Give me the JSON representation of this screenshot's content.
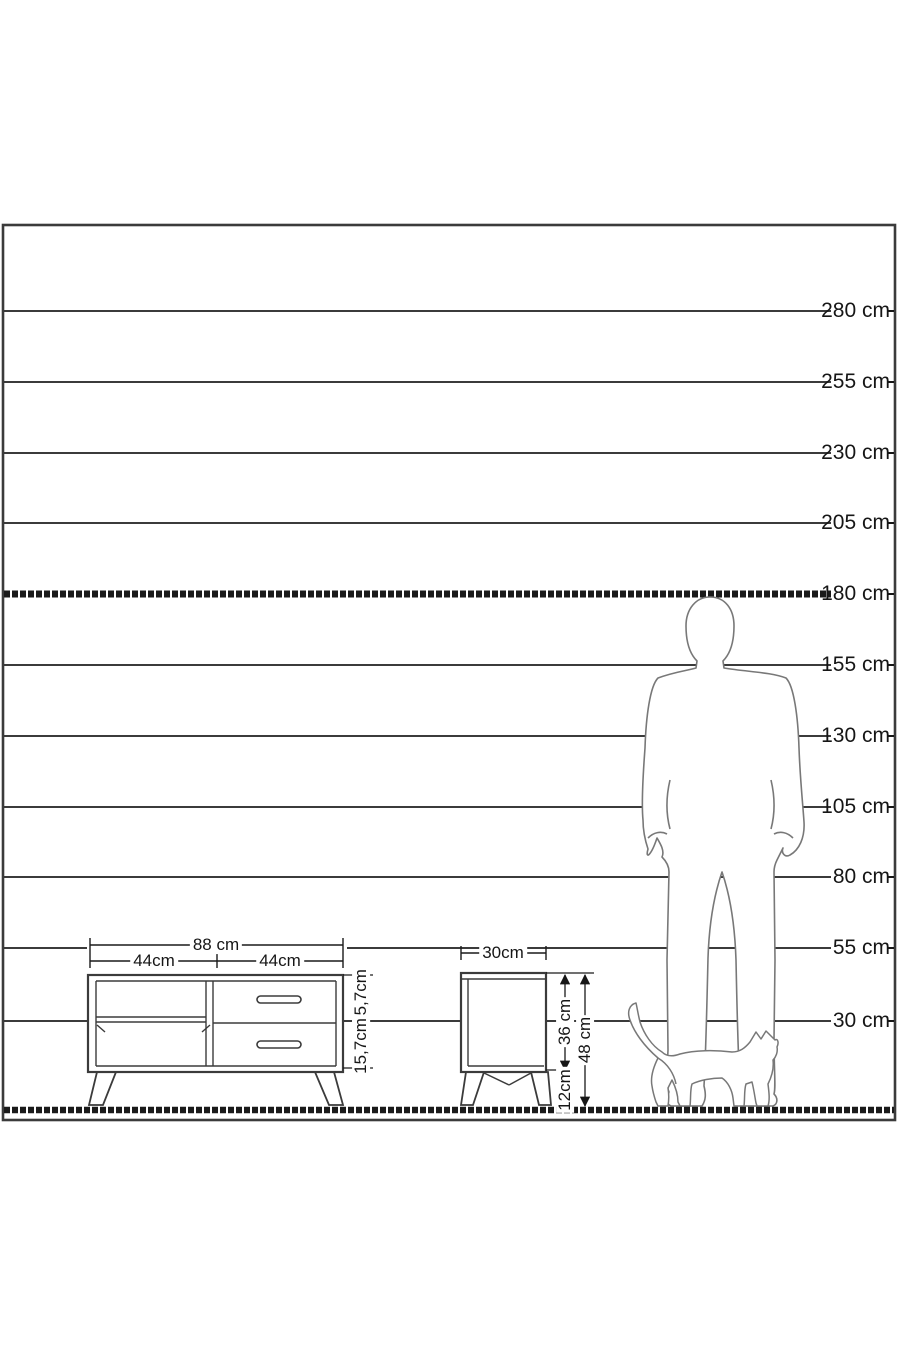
{
  "diagram": {
    "description": "furniture height comparison diagram",
    "background_color": "#ffffff",
    "line_color": "#3b3b3b",
    "silhouette_color": "#787878",
    "scale_labels": [
      "280 cm",
      "255 cm",
      "230 cm",
      "205 cm",
      "180 cm",
      "155 cm",
      "130 cm",
      "105 cm",
      "80 cm",
      "55 cm",
      "30 cm"
    ]
  },
  "tv_stand": {
    "total_width_label": "88 cm",
    "left_section_width_label": "44cm",
    "right_section_width_label": "44cm",
    "upper_compartment_height_label": "15,7cm",
    "lower_compartment_height_label": "15,7cm"
  },
  "nightstand": {
    "depth_label": "30cm",
    "body_height_label": "36 cm",
    "leg_height_label": "12cm",
    "total_height_label": "48 cm"
  },
  "figures": {
    "man": "man-silhouette",
    "cat": "cat-silhouette"
  }
}
